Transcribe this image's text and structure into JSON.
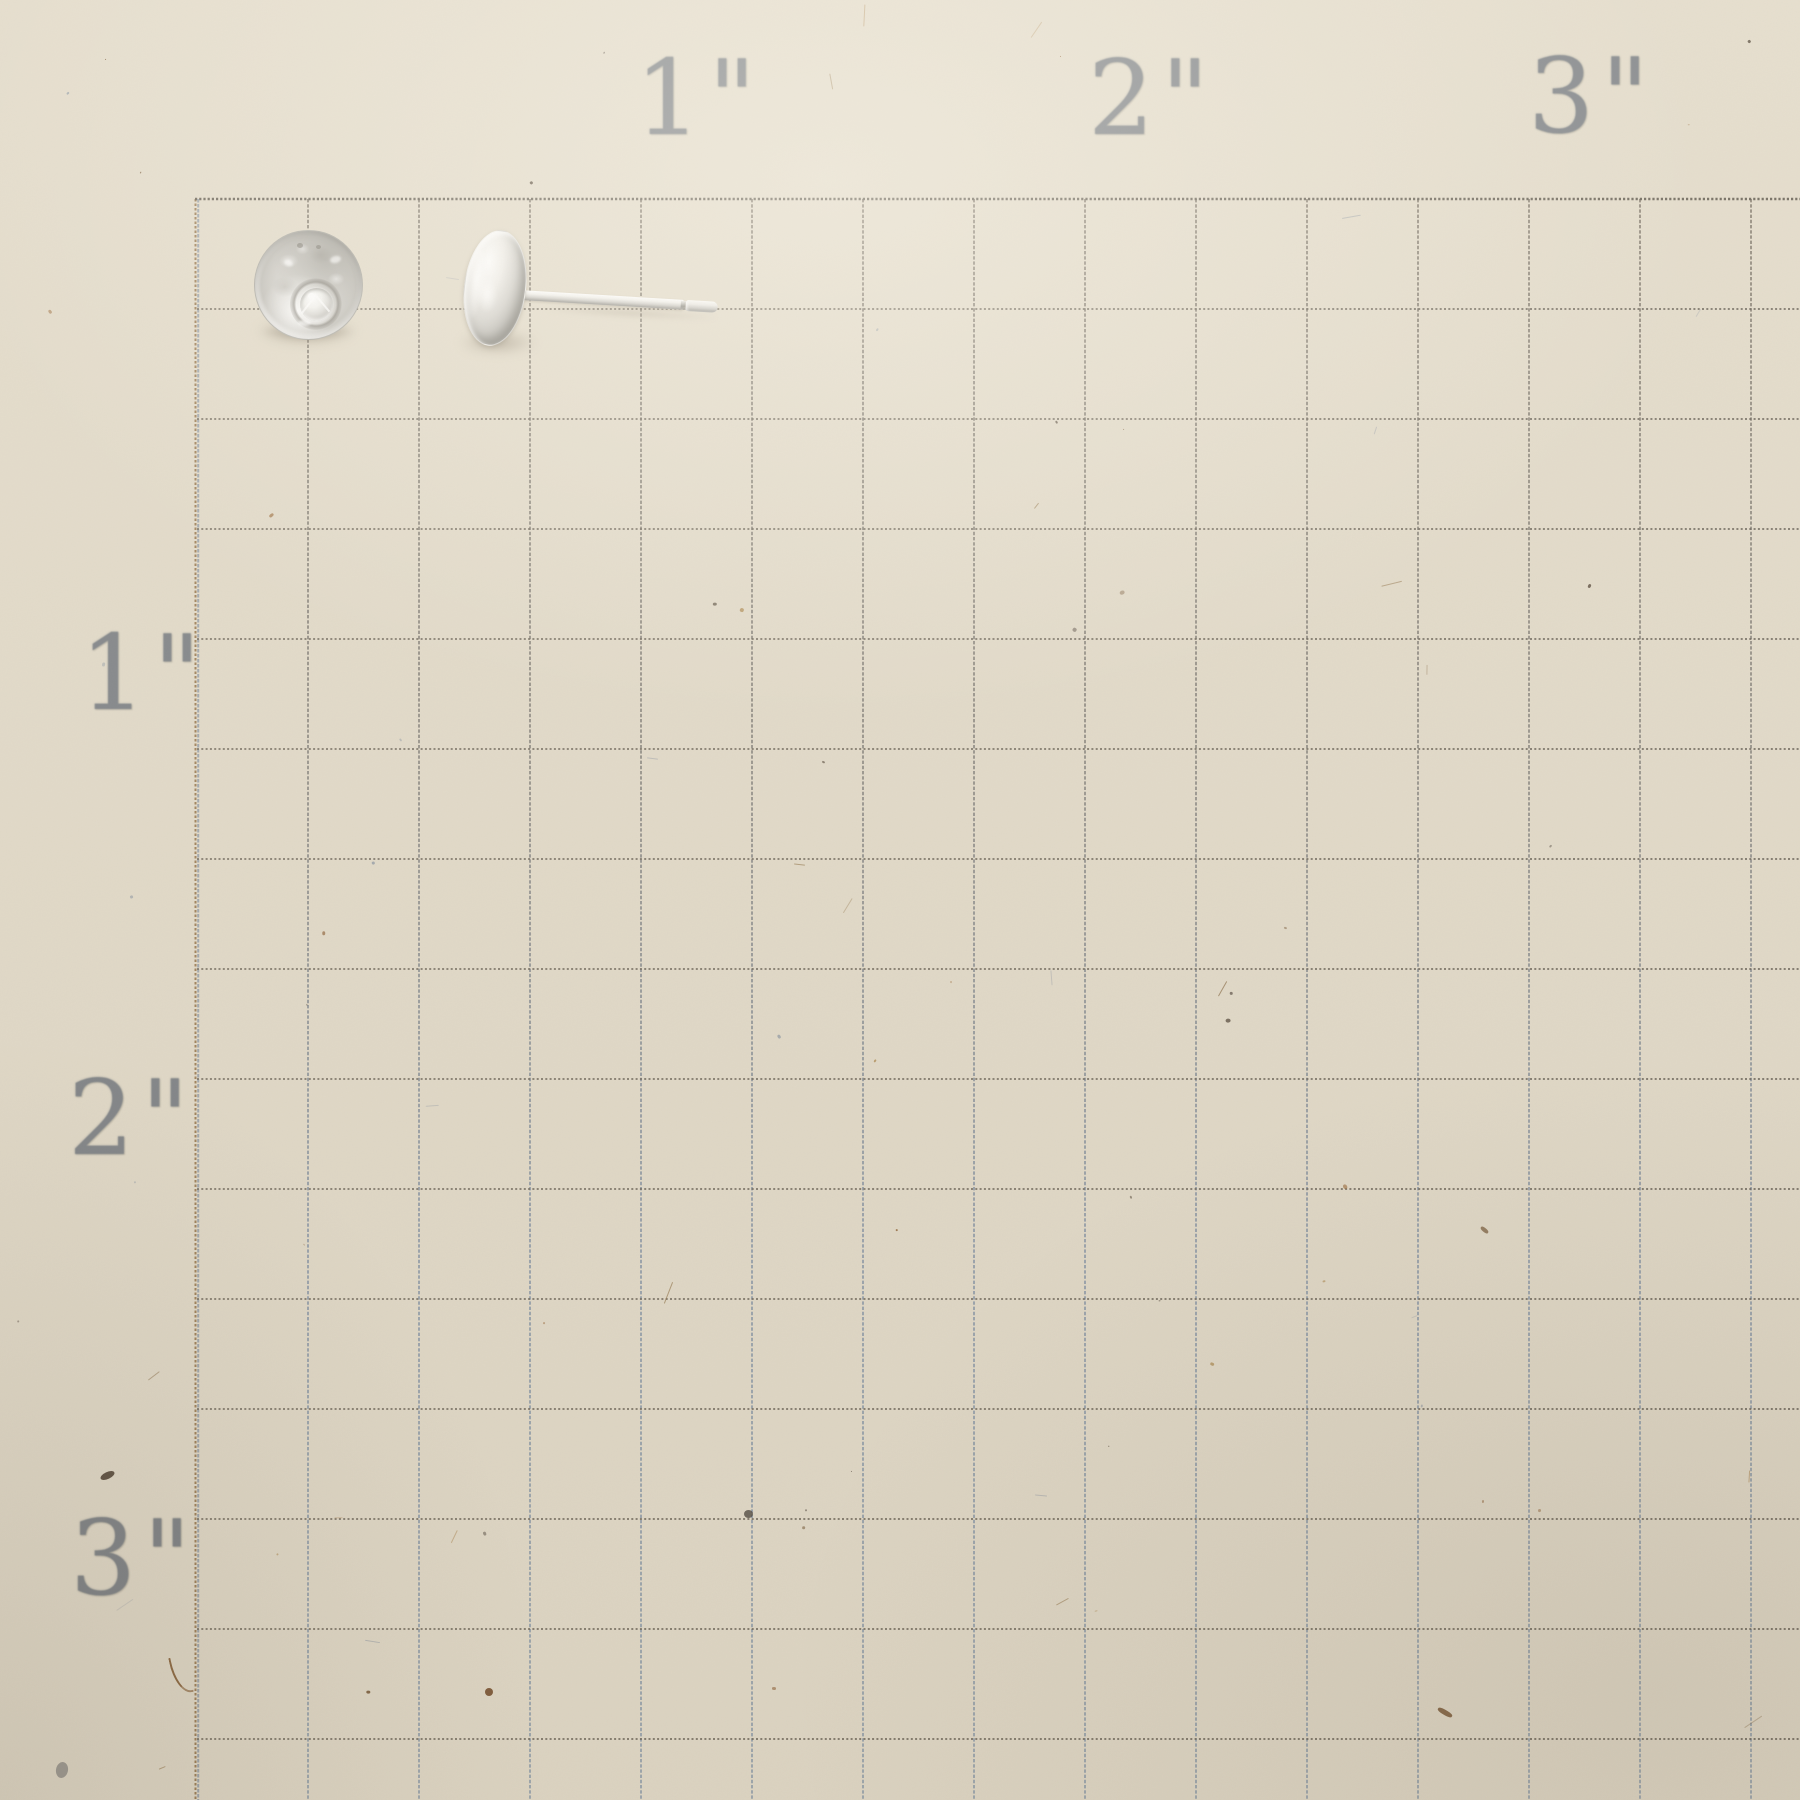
{
  "photo": {
    "description": "Pair of sterling silver pebble stud earrings photographed on inch-grid measuring paper",
    "items": [
      {
        "name": "stud-front-view",
        "detail": "round hammered silver stud shown face up with small round gemstone set near lower center"
      },
      {
        "name": "stud-side-view",
        "detail": "matching stud shown in profile with earring post extending to the right"
      }
    ]
  },
  "ruler": {
    "top_labels": [
      "1\"",
      "2\"",
      "3\""
    ],
    "left_labels": [
      "1\"",
      "2\"",
      "3\""
    ],
    "cells_per_inch": 4
  },
  "colors": {
    "paper": "#e3dbc9",
    "label_ink": "#6f757c",
    "grid_brown_ink": "#6f675a",
    "grid_blue_ink": "#8b97a5",
    "silver_highlight": "#f4f3f0",
    "silver_mid": "#cfcdc8",
    "silver_shadow": "#8f8d88"
  }
}
